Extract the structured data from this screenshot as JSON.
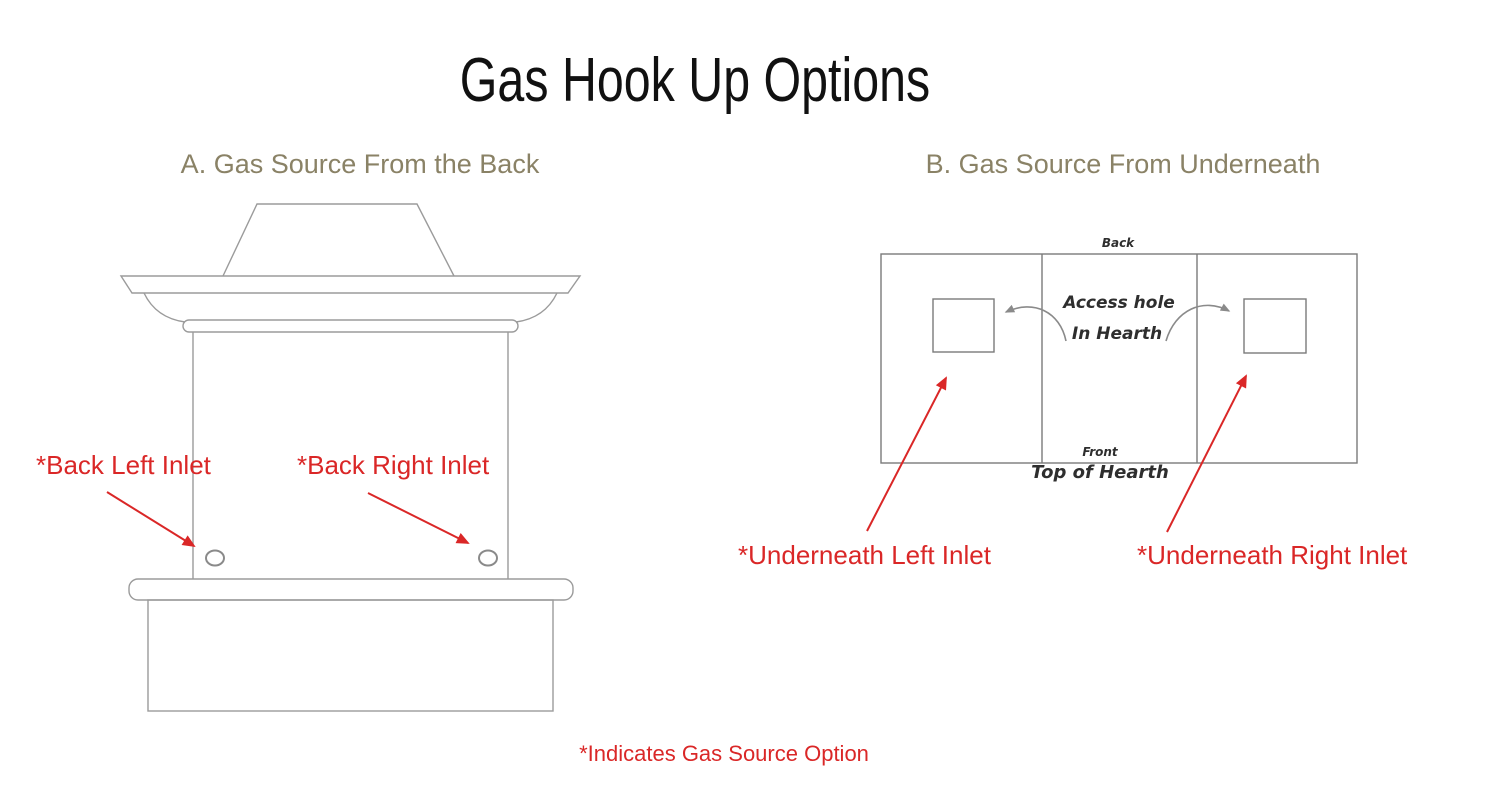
{
  "page": {
    "title": "Gas Hook Up Options",
    "footnote": "*Indicates Gas Source Option"
  },
  "colors": {
    "red": "#da2727",
    "heading": "#8a8266",
    "line_a": "#9b9b9b",
    "line_b": "#7a7a7a",
    "ink": "#2e2e2e",
    "title": "#111111"
  },
  "section_a": {
    "heading": "A. Gas Source From the Back",
    "labels": {
      "back_left": "*Back Left Inlet",
      "back_right": "*Back Right Inlet"
    }
  },
  "section_b": {
    "heading": "B. Gas Source From Underneath",
    "diagram": {
      "back": "Back",
      "front": "Front",
      "access_line1": "Access hole",
      "access_line2": "In Hearth",
      "top_of_hearth": "Top of Hearth"
    },
    "labels": {
      "underneath_left": "*Underneath Left Inlet",
      "underneath_right": "*Underneath Right Inlet"
    }
  }
}
